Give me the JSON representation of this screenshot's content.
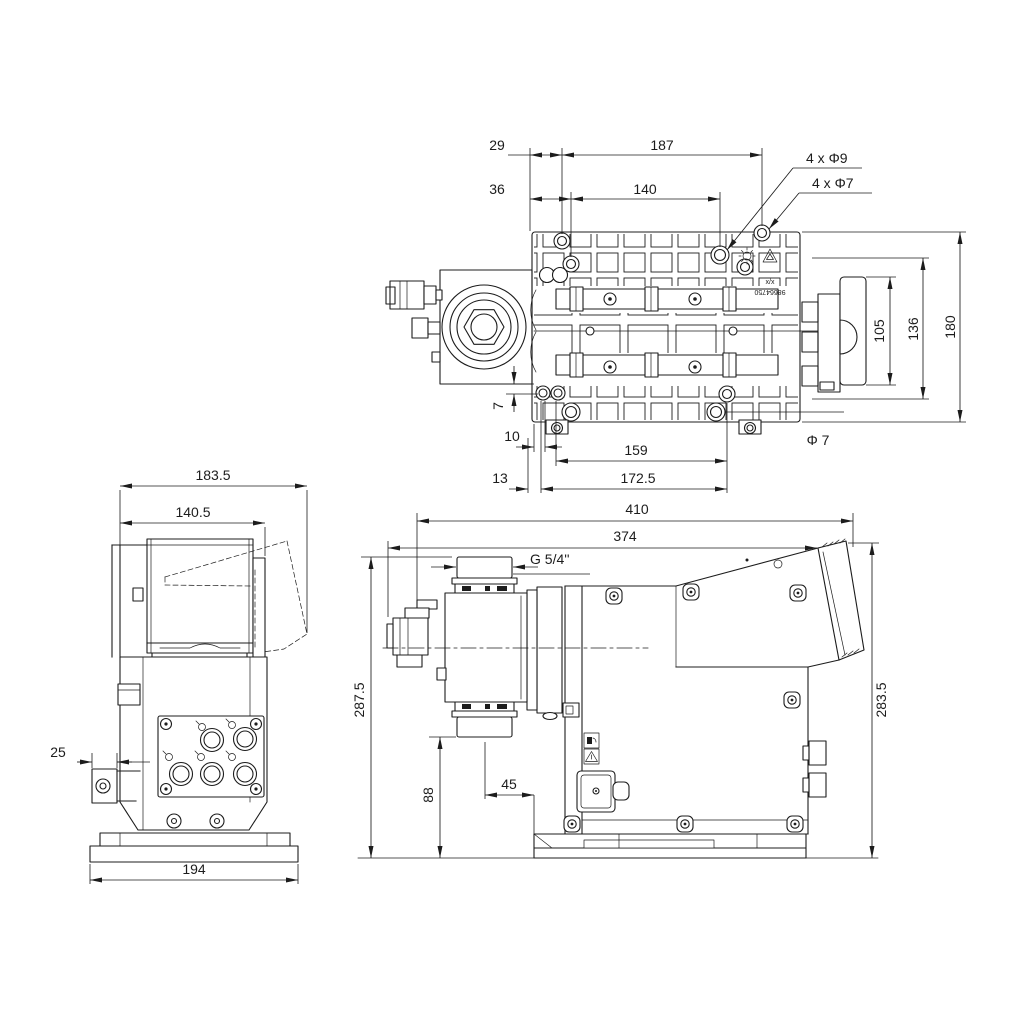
{
  "colors": {
    "ink": "#1c1c1c",
    "background": "#ffffff"
  },
  "views": {
    "top": {
      "dims": {
        "d29": "29",
        "d187": "187",
        "d36": "36",
        "d140": "140",
        "d4x9": "4 x Φ9",
        "d4x7": "4 x Φ7",
        "d105": "105",
        "d136": "136",
        "d180": "180",
        "d7": "7",
        "d10": "10",
        "d159": "159",
        "dia7": "Φ 7",
        "d13": "13",
        "d172_5": "172.5"
      },
      "marking": {
        "line1": "x/x",
        "line2": "98664750"
      }
    },
    "rear": {
      "dims": {
        "d183_5": "183.5",
        "d140_5": "140.5",
        "d25": "25",
        "d194": "194"
      }
    },
    "side": {
      "dims": {
        "d410": "410",
        "d374": "374",
        "dthread": "G 5/4''",
        "d287_5": "287.5",
        "d88": "88",
        "d45": "45",
        "d283_5": "283.5"
      }
    }
  }
}
